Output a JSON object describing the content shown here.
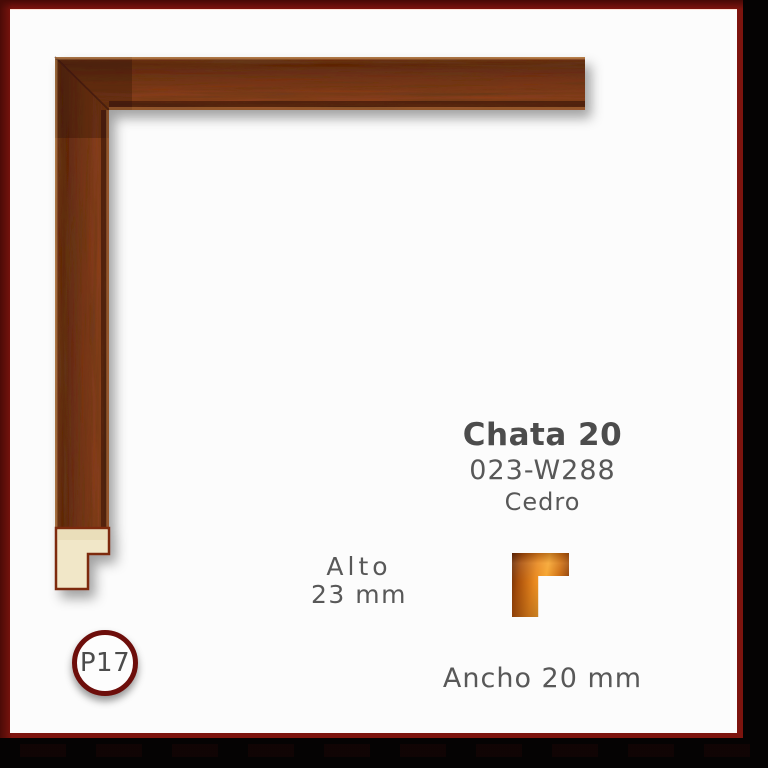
{
  "product": {
    "name": "Chata 20",
    "code": "023-W288",
    "material": "Cedro"
  },
  "dimensions": {
    "height_label": "Alto",
    "height_value": "23 mm",
    "width_label": "Ancho 20 mm"
  },
  "badge": {
    "label": "P17"
  },
  "icons": {
    "profile": "moulding-cross-section-icon"
  },
  "colors": {
    "frame_red": "#7d140e",
    "background_black": "#050303",
    "card_white": "#fcfcfc",
    "wood_mid": "#7a3316",
    "wood_dark": "#5c2410",
    "wood_highlight": "#b07c48",
    "raw_wood_cream": "#f1e7c8",
    "icon_orange": "#e8871d",
    "text_gray": "#4f4f4f"
  }
}
